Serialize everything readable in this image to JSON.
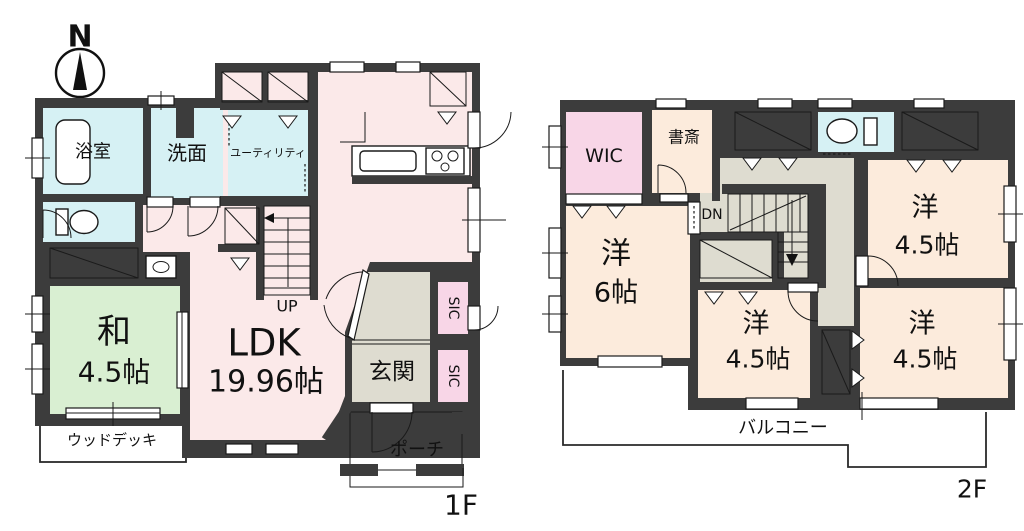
{
  "compass": {
    "north_label": "N"
  },
  "colors": {
    "wall": "#3c3c3c",
    "ldk": "#fbe9e9",
    "water": "#d6f1f4",
    "closet": "#f8d6e7",
    "tatami": "#d9efd2",
    "hall": "#dedcd0",
    "cream": "#fcebdc"
  },
  "floor1": {
    "label": "1F",
    "bath": "浴室",
    "washroom": "洗面",
    "utility": "ユーティリティ",
    "japanese_room_name": "和",
    "japanese_room_size": "4.5帖",
    "ldk_name": "LDK",
    "ldk_size": "19.96帖",
    "entrance": "玄関",
    "sic_upper": "SIC",
    "sic_lower": "SIC",
    "porch": "ポーチ",
    "wood_deck": "ウッドデッキ",
    "stairs": "UP"
  },
  "floor2": {
    "label": "2F",
    "wic": "WIC",
    "study": "書斎",
    "stairs": "DN",
    "west6_name": "洋",
    "west6_size": "6帖",
    "west45_tr_name": "洋",
    "west45_tr_size": "4.5帖",
    "west45_bm_name": "洋",
    "west45_bm_size": "4.5帖",
    "west45_br_name": "洋",
    "west45_br_size": "4.5帖",
    "balcony": "バルコニー"
  }
}
